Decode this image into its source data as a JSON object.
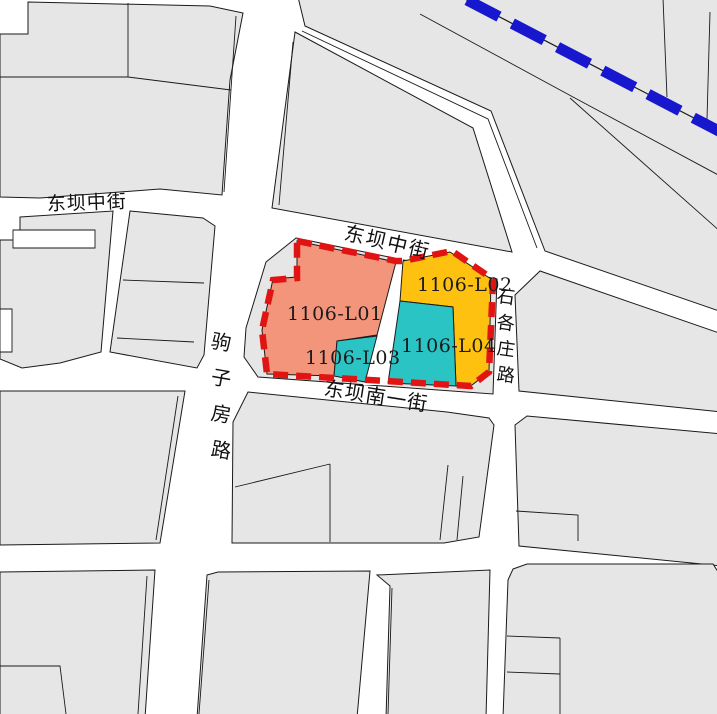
{
  "map": {
    "title": "land-parcel planning map",
    "background_color": "#ffffff",
    "parcel_fill_color": "#e6e6e6",
    "outline_color": "#1a1a1a",
    "boundary": {
      "name": "plot red-line boundary",
      "color": "#e11414",
      "style": "dashed"
    },
    "metro_line": {
      "name": "blue dashed corridor line",
      "color": "#1717ce",
      "style": "dashed"
    },
    "parcels": {
      "l01": {
        "id": "1106-L01",
        "color": "#f2957b"
      },
      "l02": {
        "id": "1106-L02",
        "color": "#ffc110"
      },
      "l03": {
        "id": "1106-L03",
        "color": "#2bc4c5"
      },
      "l04": {
        "id": "1106-L04",
        "color": "#2bc4c5"
      }
    },
    "streets": [
      {
        "name": "东坝中街",
        "orientation": "horizontal"
      },
      {
        "name": "东坝中街",
        "orientation": "horizontal"
      },
      {
        "name": "东坝南一街",
        "orientation": "horizontal"
      },
      {
        "name": "驹子房路",
        "orientation": "vertical"
      },
      {
        "name": "石各庄路",
        "orientation": "vertical"
      }
    ]
  }
}
